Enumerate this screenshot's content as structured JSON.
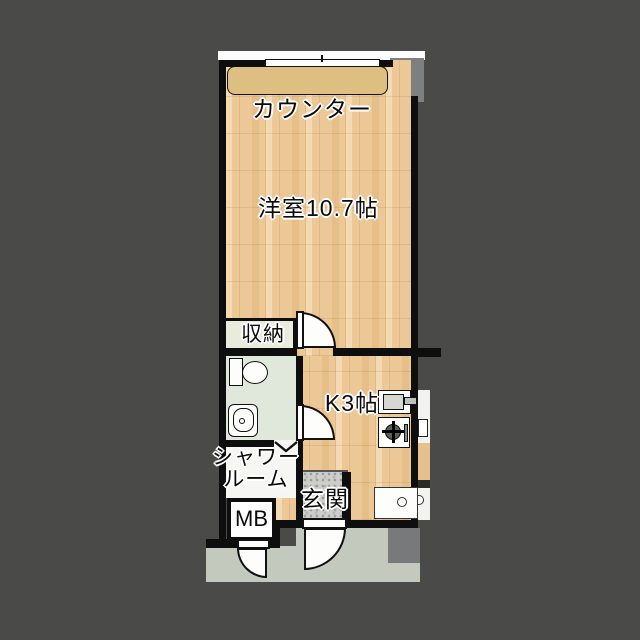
{
  "floorplan": {
    "title": "1K apartment floor plan",
    "labels": {
      "counter": "カウンター",
      "main_room": "洋室10.7帖",
      "storage": "収納",
      "kitchen": "K3帖",
      "shower_line1": "シャワー",
      "shower_line2": "ルーム",
      "entrance": "玄関",
      "meter_box": "MB"
    },
    "colors": {
      "background": "#4a4a49",
      "wall": "#0e0e0e",
      "wood_floor": "#ecc897",
      "counter": "#dcbf81",
      "storage_floor": "#e9ecdd",
      "washroom_floor": "#dfe8da",
      "shower_floor": "#f6f6f3",
      "entrance_tile": "#cdcdca",
      "walkway": "#c3c9bd",
      "pillar_gray": "#7e7f80",
      "window_white": "#fdfdfd"
    }
  }
}
